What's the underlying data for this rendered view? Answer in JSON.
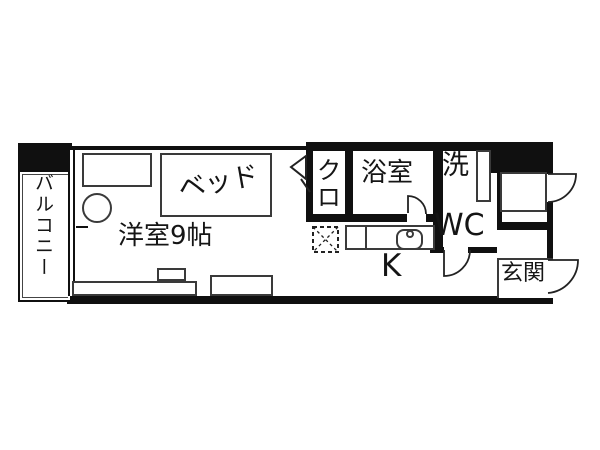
{
  "floorplan": {
    "type": "apartment-floor-plan",
    "background_color": "#ffffff",
    "wall_color": "#101010",
    "line_color": "#3a3a3a",
    "labels": {
      "balcony": "バルコニー",
      "main_room": "洋室9帖",
      "bed": "ベッド",
      "closet": "クロ",
      "bathroom": "浴室",
      "laundry": "洗",
      "toilet": "WC",
      "kitchen": "K",
      "entrance": "玄関"
    }
  }
}
